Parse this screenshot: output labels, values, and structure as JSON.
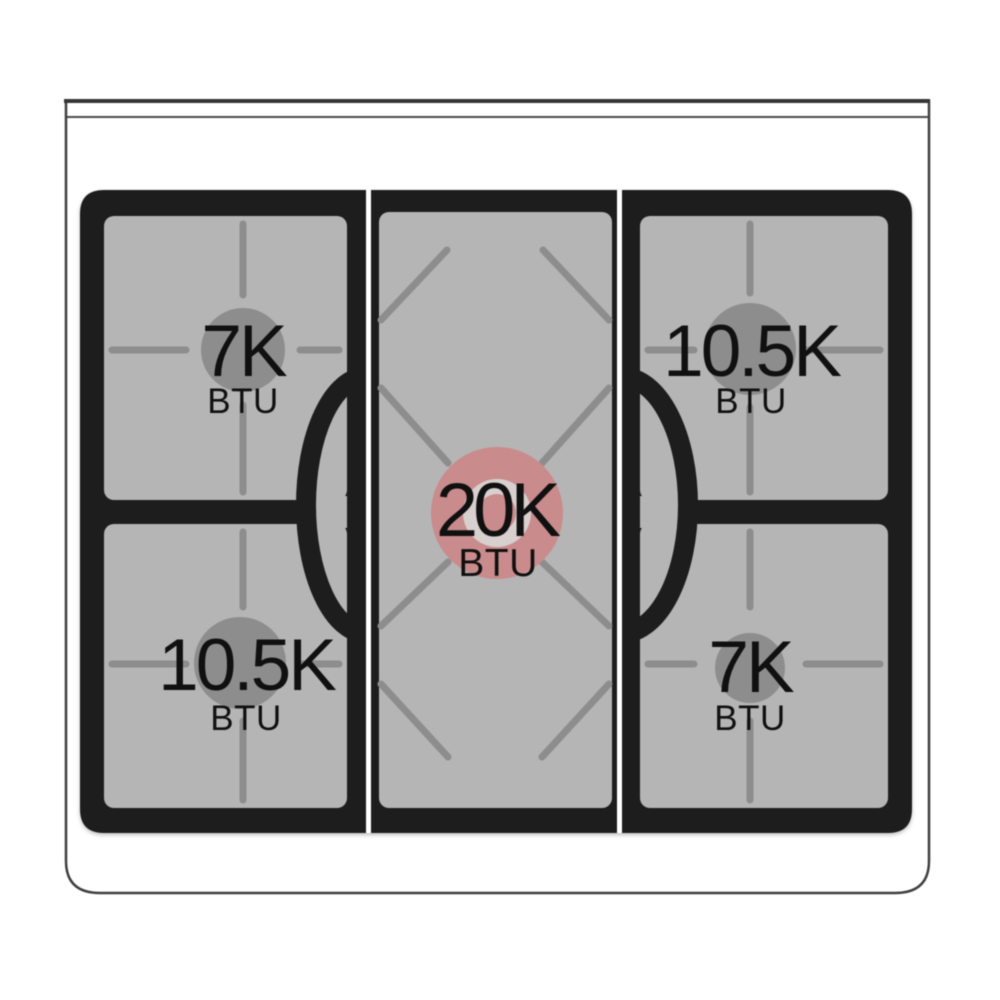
{
  "title": "Gas range cooktop burner power diagram",
  "colors": {
    "background": "#ffffff",
    "cooktop_black": "#1d1d1d",
    "panel_gray": "#b5b5b6",
    "grate_gray": "#8d8d8d",
    "burner_gray": "#8d8d8d",
    "center_highlight": "#c98b8c",
    "center_ring": "#d8cfcf",
    "outline_gray": "#3f3f3f",
    "divider_white": "#ffffff",
    "label_black": "#101010"
  },
  "burners": {
    "top_left": {
      "position": "top left",
      "power": "7K",
      "unit": "BTU"
    },
    "top_right": {
      "position": "top right",
      "power": "10.5K",
      "unit": "BTU"
    },
    "center": {
      "position": "center",
      "power": "20K",
      "unit": "BTU",
      "highlighted": true
    },
    "bottom_left": {
      "position": "bottom left",
      "power": "10.5K",
      "unit": "BTU"
    },
    "bottom_right": {
      "position": "bottom right",
      "power": "7K",
      "unit": "BTU"
    }
  }
}
